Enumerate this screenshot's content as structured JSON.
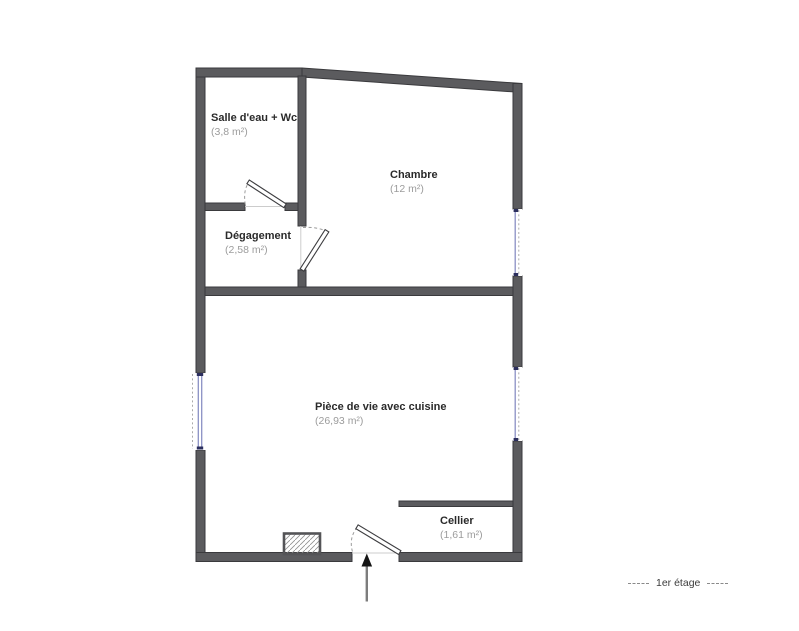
{
  "plan": {
    "floor_label": "1er étage",
    "rooms": [
      {
        "id": "salle-deau",
        "name": "Salle d'eau + Wc",
        "area": "(3,8 m²)"
      },
      {
        "id": "chambre",
        "name": "Chambre",
        "area": "(12 m²)"
      },
      {
        "id": "degagement",
        "name": "Dégagement",
        "area": "(2,58 m²)"
      },
      {
        "id": "piece-de-vie",
        "name": "Pièce de vie avec cuisine",
        "area": "(26,93 m²)"
      },
      {
        "id": "cellier",
        "name": "Cellier",
        "area": "(1,61 m²)"
      }
    ],
    "colors": {
      "wall": "#5b5b5e",
      "wall_edge": "#3a3a3d",
      "window_glass_line": "#8b90c4",
      "window_cap": "#2c2f5e",
      "room_name": "#2a2a2a",
      "area_text": "#9c9c9c",
      "door_arc": "#9a9a9a",
      "arrow": "#7d7d7d"
    }
  }
}
